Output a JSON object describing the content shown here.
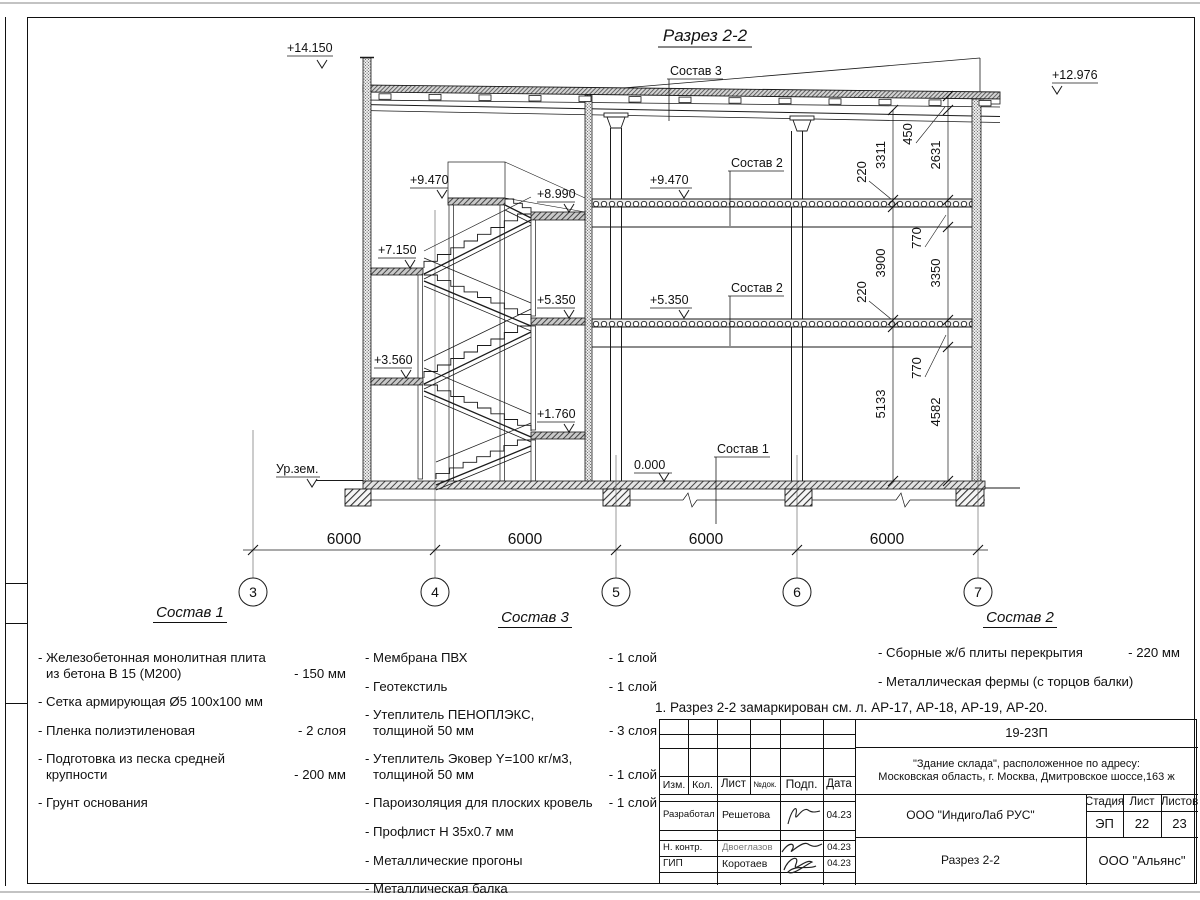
{
  "drawing": {
    "title": "Разрез 2-2",
    "elevation_marks": [
      "+14.150",
      "+12.976",
      "+9.470",
      "+8.990",
      "+7.150",
      "+5.350",
      "+3.560",
      "+1.760",
      "+9.470",
      "+5.350",
      "0.000",
      "Ур.зем."
    ],
    "leaders": [
      "Состав 3",
      "Состав 2",
      "Состав 2",
      "Состав 1"
    ],
    "dims_bottom": [
      "6000",
      "6000",
      "6000",
      "6000"
    ],
    "axes": [
      "3",
      "4",
      "5",
      "6",
      "7"
    ],
    "dims_inner": [
      "3311",
      "220",
      "3900",
      "220",
      "5133"
    ],
    "dims_outer": [
      "450",
      "2631",
      "770",
      "3350",
      "770",
      "4582"
    ]
  },
  "legend1": {
    "title": "Состав 1",
    "items": [
      {
        "line1": "- Железобетонная  монолитная плита",
        "line2": "из бетона В 15 (М200)",
        "value": "- 150 мм"
      },
      {
        "line1": "- Сетка армирующая Ø5 100х100 мм",
        "line2": "",
        "value": ""
      },
      {
        "line1": "- Пленка полиэтиленовая",
        "line2": "",
        "value": "- 2 слоя"
      },
      {
        "line1": "- Подготовка из песка средней",
        "line2": "крупности",
        "value": "- 200 мм"
      },
      {
        "line1": "- Грунт основания",
        "line2": "",
        "value": ""
      }
    ]
  },
  "legend3": {
    "title": "Состав 3",
    "items": [
      {
        "line1": "- Мембрана ПВХ",
        "line2": "",
        "value": "- 1 слой"
      },
      {
        "line1": "- Геотекстиль",
        "line2": "",
        "value": "- 1 слой"
      },
      {
        "line1": "- Утеплитель ПЕНОПЛЭКС,",
        "line2": "толщиной 50 мм",
        "value": "- 3 слоя"
      },
      {
        "line1": "- Утеплитель Эковер Y=100 кг/м3,",
        "line2": "толщиной 50 мм",
        "value": "- 1 слой"
      },
      {
        "line1": "- Пароизоляция для плоских кровель",
        "line2": "",
        "value": "- 1 слой"
      },
      {
        "line1": "- Профлист Н 35х0.7 мм",
        "line2": "",
        "value": ""
      },
      {
        "line1": "- Металлические прогоны",
        "line2": "",
        "value": ""
      },
      {
        "line1": "- Металлическая балка",
        "line2": "",
        "value": ""
      }
    ]
  },
  "legend2": {
    "title": "Состав 2",
    "items": [
      {
        "line1": "- Сборные ж/б плиты перекрытия",
        "line2": "",
        "value": "- 220 мм"
      },
      {
        "line1": "- Металлическая фермы (с торцов балки)",
        "line2": "",
        "value": ""
      }
    ]
  },
  "note": "1. Разрез 2-2 замаркирован см. л. АР-17, АР-18, АР-19, АР-20.",
  "titleblock": {
    "code": "19-23П",
    "object_line1": "\"Здание склада\", расположенное по адресу:",
    "object_line2": "Московская область, г. Москва, Дмитровское шоссе,163 ж",
    "company": "ООО \"ИндигоЛаб РУС\"",
    "sheet_title": "Разрез 2-2",
    "contractor": "ООО \"Альянс\"",
    "stage_label": "Стадия",
    "sheet_label": "Лист",
    "sheets_label": "Листов",
    "stage": "ЭП",
    "sheet": "22",
    "sheets": "23",
    "cols": [
      "Изм.",
      "Кол.",
      "Лист",
      "№док.",
      "Подп.",
      "Дата"
    ],
    "rows": [
      {
        "role": "Разработал",
        "name": "Решетова",
        "date": "04.23"
      },
      {
        "role": "Н. контр.",
        "name": "Двоеглазов",
        "date": "04.23"
      },
      {
        "role": "ГИП",
        "name": "Коротаев",
        "date": "04.23"
      }
    ]
  }
}
